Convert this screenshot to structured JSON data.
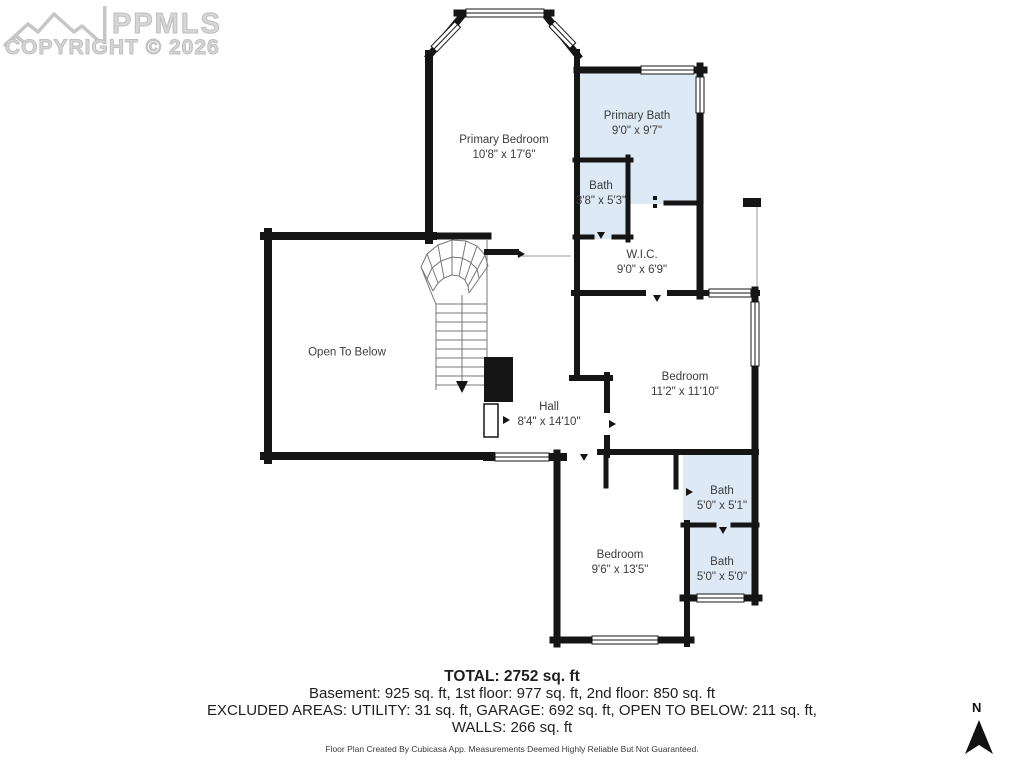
{
  "watermark": {
    "logo": "ppmls-mountains-logo",
    "brand": "PPMLS",
    "copyright": "COPYRIGHT © 2026"
  },
  "rooms": [
    {
      "name": "Primary Bedroom",
      "dims": "10'8\" x 17'6\""
    },
    {
      "name": "Primary Bath",
      "dims": "9'0\" x 9'7\""
    },
    {
      "name": "Bath",
      "dims": "3'8\" x 5'3\""
    },
    {
      "name": "W.I.C.",
      "dims": "9'0\" x 6'9\""
    },
    {
      "name": "Open To Below",
      "dims": ""
    },
    {
      "name": "Bedroom",
      "dims": "11'2\" x 11'10\""
    },
    {
      "name": "Hall",
      "dims": "8'4\" x 14'10\""
    },
    {
      "name": "Bath",
      "dims": "5'0\" x 5'1\""
    },
    {
      "name": "Bath",
      "dims": "5'0\" x 5'0\""
    },
    {
      "name": "Bedroom",
      "dims": "9'6\" x 13'5\""
    }
  ],
  "summary": {
    "total": "TOTAL: 2752 sq. ft",
    "floors": "Basement: 925 sq. ft, 1st floor: 977 sq. ft, 2nd floor: 850 sq. ft",
    "excluded": "EXCLUDED AREAS: UTILITY: 31 sq. ft, GARAGE: 692 sq. ft, OPEN TO BELOW: 211 sq. ft,",
    "walls": "WALLS: 266 sq. ft",
    "disclaimer": "Floor Plan Created By Cubicasa App. Measurements Deemed Highly Reliable But Not Guaranteed."
  },
  "compass": {
    "label": "N"
  },
  "colors": {
    "wall": "#151515",
    "bath_fill": "#dde9f5",
    "watermark_gray": "#c9c9c9",
    "label_text": "#3c3c3c"
  }
}
